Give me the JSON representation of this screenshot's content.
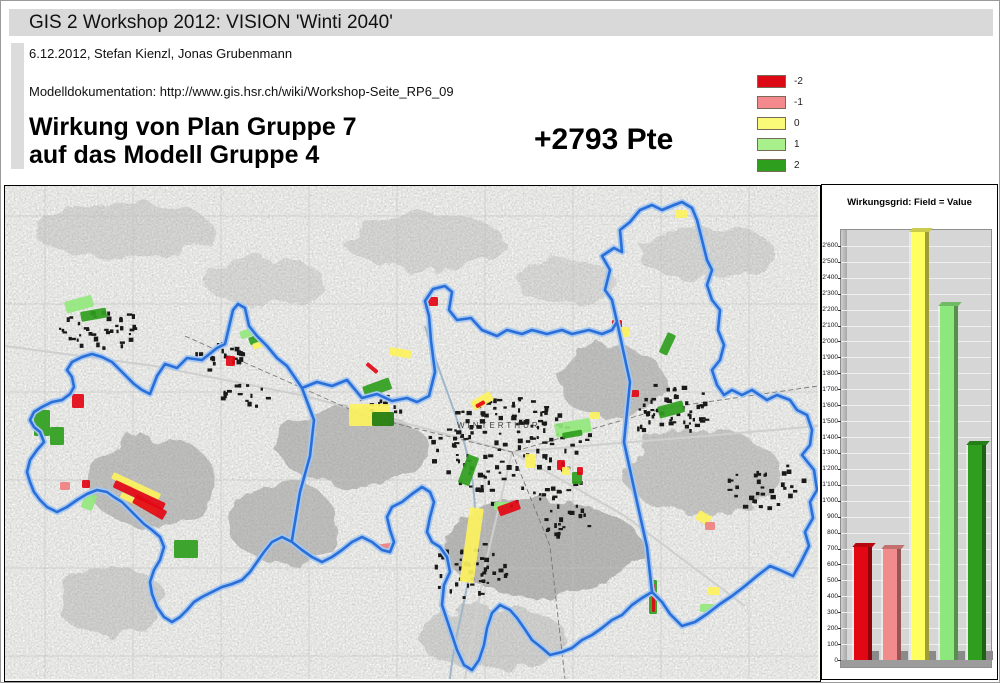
{
  "header": {
    "title": "GIS 2 Workshop 2012: VISION 'Winti 2040'",
    "subtitle": "6.12.2012, Stefan Kienzl, Jonas Grubenmann",
    "doc_line": "Modelldokumentation: http://www.gis.hsr.ch/wiki/Workshop-Seite_RP6_09",
    "main_title_line1": "Wirkung von Plan Gruppe 7",
    "main_title_line2": "auf das Modell Gruppe 4",
    "score": "+2793 Pte"
  },
  "legend": {
    "items": [
      {
        "label": "-2",
        "color": "#dc0814"
      },
      {
        "label": "-1",
        "color": "#f4898d"
      },
      {
        "label": "0",
        "color": "#fafa78"
      },
      {
        "label": "1",
        "color": "#a8f08c"
      },
      {
        "label": "2",
        "color": "#2e9e1e"
      }
    ]
  },
  "map": {
    "label": "WINTERTHUR",
    "boundary_color": "#2a6fd8",
    "boundary_halo": "#a4c6f0",
    "patch_colors": {
      "r": "#e30613",
      "sa": "#f08080",
      "y": "#fdf25e",
      "lg": "#93e87d",
      "g": "#2f9e1e",
      "dg": "#1e7a10"
    },
    "patches": [
      [
        59,
        116,
        28,
        12,
        -15,
        "lg"
      ],
      [
        75,
        126,
        26,
        10,
        -10,
        "g"
      ],
      [
        670,
        24,
        12,
        8,
        0,
        "y"
      ],
      [
        67,
        208,
        12,
        14,
        0,
        "r"
      ],
      [
        29,
        224,
        16,
        26,
        0,
        "g"
      ],
      [
        45,
        241,
        14,
        18,
        0,
        "g"
      ],
      [
        55,
        296,
        10,
        8,
        0,
        "sa"
      ],
      [
        77,
        294,
        8,
        8,
        0,
        "r"
      ],
      [
        81,
        306,
        12,
        16,
        20,
        "lg"
      ],
      [
        109,
        286,
        52,
        7,
        25,
        "y"
      ],
      [
        111,
        294,
        55,
        8,
        25,
        "r"
      ],
      [
        117,
        306,
        40,
        6,
        25,
        "y"
      ],
      [
        132,
        308,
        35,
        10,
        30,
        "r"
      ],
      [
        169,
        354,
        24,
        18,
        0,
        "g"
      ],
      [
        234,
        146,
        16,
        8,
        -20,
        "lg"
      ],
      [
        243,
        152,
        12,
        8,
        -20,
        "g"
      ],
      [
        247,
        158,
        10,
        6,
        -20,
        "y"
      ],
      [
        221,
        170,
        9,
        10,
        0,
        "r"
      ],
      [
        423,
        111,
        10,
        9,
        0,
        "r"
      ],
      [
        465,
        216,
        22,
        10,
        -30,
        "y"
      ],
      [
        470,
        219,
        10,
        4,
        -30,
        "r"
      ],
      [
        549,
        238,
        36,
        14,
        -10,
        "lg"
      ],
      [
        557,
        247,
        20,
        6,
        -10,
        "g"
      ],
      [
        463,
        268,
        12,
        30,
        20,
        "g"
      ],
      [
        520,
        268,
        10,
        14,
        0,
        "y"
      ],
      [
        552,
        274,
        8,
        10,
        0,
        "r"
      ],
      [
        557,
        281,
        8,
        8,
        0,
        "y"
      ],
      [
        567,
        286,
        10,
        12,
        0,
        "g"
      ],
      [
        572,
        281,
        6,
        8,
        0,
        "r"
      ],
      [
        585,
        226,
        10,
        7,
        0,
        "y"
      ],
      [
        625,
        204,
        9,
        7,
        0,
        "r"
      ],
      [
        607,
        134,
        10,
        8,
        0,
        "r"
      ],
      [
        612,
        141,
        12,
        10,
        0,
        "y"
      ],
      [
        663,
        146,
        9,
        22,
        25,
        "g"
      ],
      [
        652,
        221,
        26,
        12,
        -15,
        "g"
      ],
      [
        465,
        321,
        14,
        75,
        8,
        "y"
      ],
      [
        489,
        316,
        16,
        8,
        0,
        "lg"
      ],
      [
        492,
        321,
        22,
        10,
        -20,
        "r"
      ],
      [
        644,
        394,
        8,
        34,
        0,
        "g"
      ],
      [
        647,
        398,
        3,
        28,
        0,
        "r"
      ],
      [
        695,
        324,
        14,
        10,
        30,
        "y"
      ],
      [
        700,
        336,
        10,
        8,
        0,
        "sa"
      ],
      [
        703,
        401,
        12,
        8,
        0,
        "y"
      ],
      [
        695,
        418,
        14,
        8,
        0,
        "lg"
      ],
      [
        370,
        359,
        20,
        5,
        -8,
        "sa"
      ],
      [
        385,
        161,
        22,
        8,
        10,
        "y"
      ],
      [
        363,
        176,
        14,
        4,
        40,
        "r"
      ],
      [
        344,
        218,
        40,
        22,
        0,
        "y"
      ],
      [
        357,
        201,
        28,
        12,
        -20,
        "g"
      ],
      [
        367,
        226,
        22,
        14,
        0,
        "dg"
      ]
    ],
    "building_clusters": [
      {
        "cx": 507,
        "cy": 266,
        "rx": 85,
        "ry": 55,
        "n": 150
      },
      {
        "cx": 95,
        "cy": 142,
        "rx": 40,
        "ry": 22,
        "n": 40
      },
      {
        "cx": 212,
        "cy": 172,
        "rx": 28,
        "ry": 14,
        "n": 22
      },
      {
        "cx": 662,
        "cy": 222,
        "rx": 45,
        "ry": 28,
        "n": 55
      },
      {
        "cx": 465,
        "cy": 385,
        "rx": 38,
        "ry": 30,
        "n": 45
      },
      {
        "cx": 760,
        "cy": 300,
        "rx": 40,
        "ry": 26,
        "n": 35
      },
      {
        "cx": 240,
        "cy": 210,
        "rx": 24,
        "ry": 12,
        "n": 15
      },
      {
        "cx": 373,
        "cy": 222,
        "rx": 24,
        "ry": 12,
        "n": 15
      },
      {
        "cx": 560,
        "cy": 335,
        "rx": 28,
        "ry": 18,
        "n": 20
      }
    ]
  },
  "chart_data": {
    "type": "bar",
    "title": "Wirkungsgrid: Field = Value",
    "categories": [
      "-2",
      "-1",
      "0",
      "1",
      "2"
    ],
    "values": [
      710,
      700,
      2690,
      2220,
      1350
    ],
    "colors": [
      "#e30613",
      "#f28b8b",
      "#ffff5f",
      "#8ce87c",
      "#2f9e1e"
    ],
    "xlabel": "",
    "ylabel": "",
    "ylim": [
      0,
      2700
    ],
    "ytick_step": 100,
    "ytick_max_label": 2600,
    "ytick_format": "swiss-apostrophe",
    "grid": true,
    "legend_position": "none",
    "plot_bg": "#d6d6d6"
  }
}
